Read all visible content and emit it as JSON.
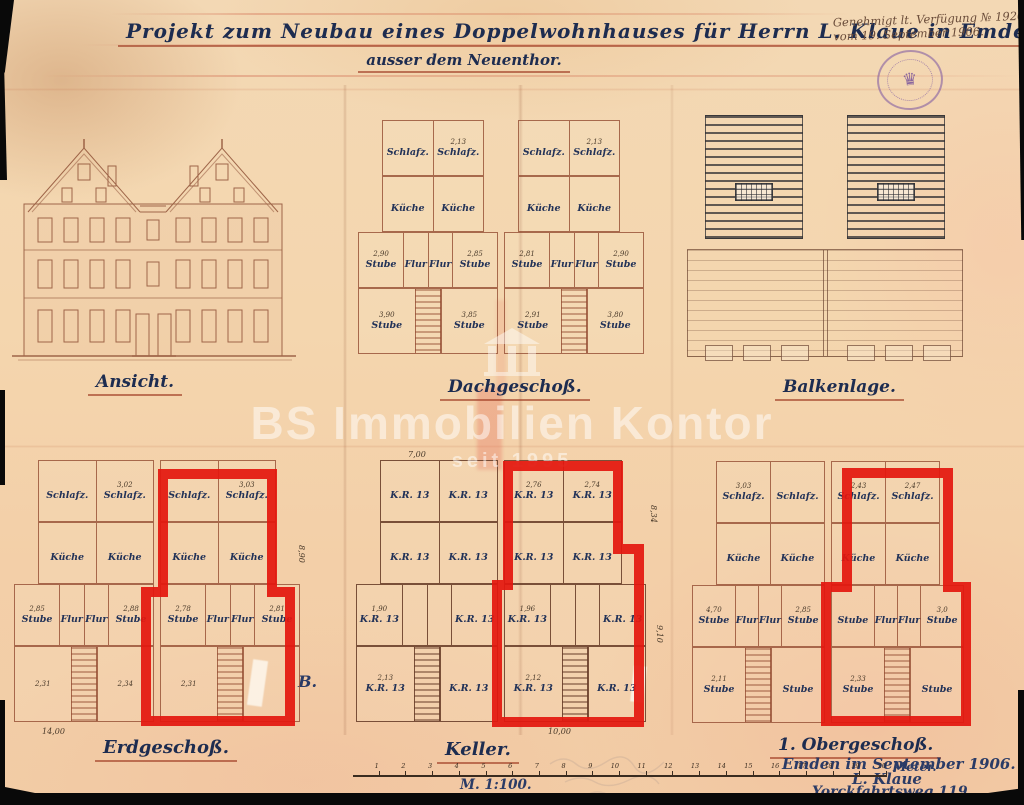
{
  "title": {
    "line1": "Projekt zum Neubau eines Doppelwohnhauses für Herrn L. Klaue in Emden",
    "line2": "ausser dem Neuenthor."
  },
  "approval": {
    "line1": "Genehmigt lt. Verfügung № 19207",
    "line2": "vom 19. September 1906."
  },
  "stamp": {
    "crest": "♛"
  },
  "watermark": {
    "brand": "BS Immobilien Kontor",
    "since": "seit 1995"
  },
  "labels": {
    "ansicht": "Ansicht.",
    "dachgeschoss": "Dachgeschoß.",
    "balkenlage": "Balkenlage.",
    "erdgeschoss": "Erdgeschoß.",
    "keller": "Keller.",
    "obergeschoss": "1. Obergeschoß.",
    "annotation_b": "B."
  },
  "scale": {
    "numbers": [
      "1",
      "2",
      "3",
      "4",
      "5",
      "6",
      "7",
      "8",
      "9",
      "10",
      "11",
      "12",
      "13",
      "14",
      "15",
      "16",
      "17",
      "18",
      "19",
      "20"
    ],
    "unit": "Meter.",
    "ratio": "M. 1:100."
  },
  "signature": {
    "place_date": "Emden im September 1906.",
    "name": "L. Klaue",
    "street": "Yorckfahrtsweg 119."
  },
  "boundary_dims": {
    "eg_bottom": "14,00",
    "eg_right": "8,90",
    "keller_top": "7,00",
    "keller_bottom": "10,00",
    "keller_right_upper": "8,34",
    "keller_right_lower": "9,10"
  },
  "plans": {
    "dach": {
      "rows": [
        {
          "kind": "r-inset",
          "cells": [
            {
              "dim": "",
              "label": "Schlafz."
            },
            {
              "dim": "2,13",
              "label": "Schlafz."
            },
            {
              "dim": "",
              "label": "Schlafz."
            },
            {
              "dim": "2,13",
              "label": "Schlafz."
            }
          ]
        },
        {
          "kind": "r-inset",
          "cells": [
            {
              "dim": "",
              "label": "Küche"
            },
            {
              "dim": "",
              "label": "Küche"
            },
            {
              "dim": "",
              "label": "Küche"
            },
            {
              "dim": "",
              "label": "Küche"
            }
          ]
        },
        {
          "kind": "r-full",
          "cells": [
            {
              "dim": "2,90",
              "label": "Stube"
            },
            {
              "dim": "",
              "label": "Flur"
            },
            {
              "dim": "",
              "label": "Flur"
            },
            {
              "dim": "2,85",
              "label": "Stube"
            },
            {
              "dim": "2,81",
              "label": "Stube"
            },
            {
              "dim": "",
              "label": "Flur"
            },
            {
              "dim": "",
              "label": "Flur"
            },
            {
              "dim": "2,90",
              "label": "Stube"
            }
          ]
        },
        {
          "kind": "r-stairs",
          "cells": [
            {
              "dim": "3,90",
              "label": "Stube"
            },
            {
              "dim": "3,85",
              "label": "Stube"
            },
            {
              "dim": "2,91",
              "label": "Stube"
            },
            {
              "dim": "3,80",
              "label": "Stube"
            }
          ]
        }
      ]
    },
    "erdgeschoss": {
      "rows": [
        {
          "kind": "r-inset",
          "cells": [
            {
              "dim": "",
              "label": "Schlafz."
            },
            {
              "dim": "3,02",
              "label": "Schlafz."
            },
            {
              "dim": "",
              "label": "Schlafz."
            },
            {
              "dim": "3,03",
              "label": "Schlafz."
            }
          ]
        },
        {
          "kind": "r-inset",
          "cells": [
            {
              "dim": "",
              "label": "Küche"
            },
            {
              "dim": "",
              "label": "Küche"
            },
            {
              "dim": "",
              "label": "Küche"
            },
            {
              "dim": "",
              "label": "Küche"
            }
          ]
        },
        {
          "kind": "r-full",
          "cells": [
            {
              "dim": "2,85",
              "label": "Stube"
            },
            {
              "dim": "",
              "label": "Flur"
            },
            {
              "dim": "",
              "label": "Flur"
            },
            {
              "dim": "2,88",
              "label": "Stube"
            },
            {
              "dim": "2,78",
              "label": "Stube"
            },
            {
              "dim": "",
              "label": "Flur"
            },
            {
              "dim": "",
              "label": "Flur"
            },
            {
              "dim": "2,81",
              "label": "Stube"
            }
          ]
        },
        {
          "kind": "r-stairs",
          "cells": [
            {
              "dim": "2,31",
              "label": ""
            },
            {
              "dim": "2,34",
              "label": ""
            },
            {
              "dim": "2,31",
              "label": ""
            },
            {
              "dim": "",
              "label": ""
            }
          ]
        }
      ]
    },
    "keller": {
      "rows": [
        {
          "kind": "r-inset",
          "cells": [
            {
              "dim": "",
              "label": "K.R. 13"
            },
            {
              "dim": "",
              "label": "K.R. 13"
            },
            {
              "dim": "2,76",
              "label": "K.R. 13"
            },
            {
              "dim": "2,74",
              "label": "K.R. 13"
            }
          ]
        },
        {
          "kind": "r-inset",
          "cells": [
            {
              "dim": "",
              "label": "K.R. 13"
            },
            {
              "dim": "",
              "label": "K.R. 13"
            },
            {
              "dim": "",
              "label": "K.R. 13"
            },
            {
              "dim": "",
              "label": "K.R. 13"
            }
          ]
        },
        {
          "kind": "r-full",
          "cells": [
            {
              "dim": "1,90",
              "label": "K.R. 13"
            },
            {
              "dim": "",
              "label": ""
            },
            {
              "dim": "",
              "label": ""
            },
            {
              "dim": "",
              "label": "K.R. 13"
            },
            {
              "dim": "1,96",
              "label": "K.R. 13"
            },
            {
              "dim": "",
              "label": ""
            },
            {
              "dim": "",
              "label": ""
            },
            {
              "dim": "",
              "label": "K.R. 13"
            }
          ]
        },
        {
          "kind": "r-stairs",
          "cells": [
            {
              "dim": "2,13",
              "label": "K.R. 13"
            },
            {
              "dim": "",
              "label": "K.R. 13"
            },
            {
              "dim": "2,12",
              "label": "K.R. 13"
            },
            {
              "dim": "",
              "label": "K.R. 13"
            }
          ]
        }
      ]
    },
    "obergeschoss": {
      "rows": [
        {
          "kind": "r-inset",
          "cells": [
            {
              "dim": "3,03",
              "label": "Schlafz."
            },
            {
              "dim": "",
              "label": "Schlafz."
            },
            {
              "dim": "2,43",
              "label": "Schlafz."
            },
            {
              "dim": "2,47",
              "label": "Schlafz."
            }
          ]
        },
        {
          "kind": "r-inset",
          "cells": [
            {
              "dim": "",
              "label": "Küche"
            },
            {
              "dim": "",
              "label": "Küche"
            },
            {
              "dim": "",
              "label": "Küche"
            },
            {
              "dim": "",
              "label": "Küche"
            }
          ]
        },
        {
          "kind": "r-full",
          "cells": [
            {
              "dim": "4,70",
              "label": "Stube"
            },
            {
              "dim": "",
              "label": "Flur"
            },
            {
              "dim": "",
              "label": "Flur"
            },
            {
              "dim": "2,85",
              "label": "Stube"
            },
            {
              "dim": "",
              "label": "Stube"
            },
            {
              "dim": "",
              "label": "Flur"
            },
            {
              "dim": "",
              "label": "Flur"
            },
            {
              "dim": "3,0",
              "label": "Stube"
            }
          ]
        },
        {
          "kind": "r-stairs",
          "cells": [
            {
              "dim": "2,11",
              "label": "Stube"
            },
            {
              "dim": "",
              "label": "Stube"
            },
            {
              "dim": "2,33",
              "label": "Stube"
            },
            {
              "dim": "",
              "label": "Stube"
            }
          ]
        }
      ]
    }
  }
}
